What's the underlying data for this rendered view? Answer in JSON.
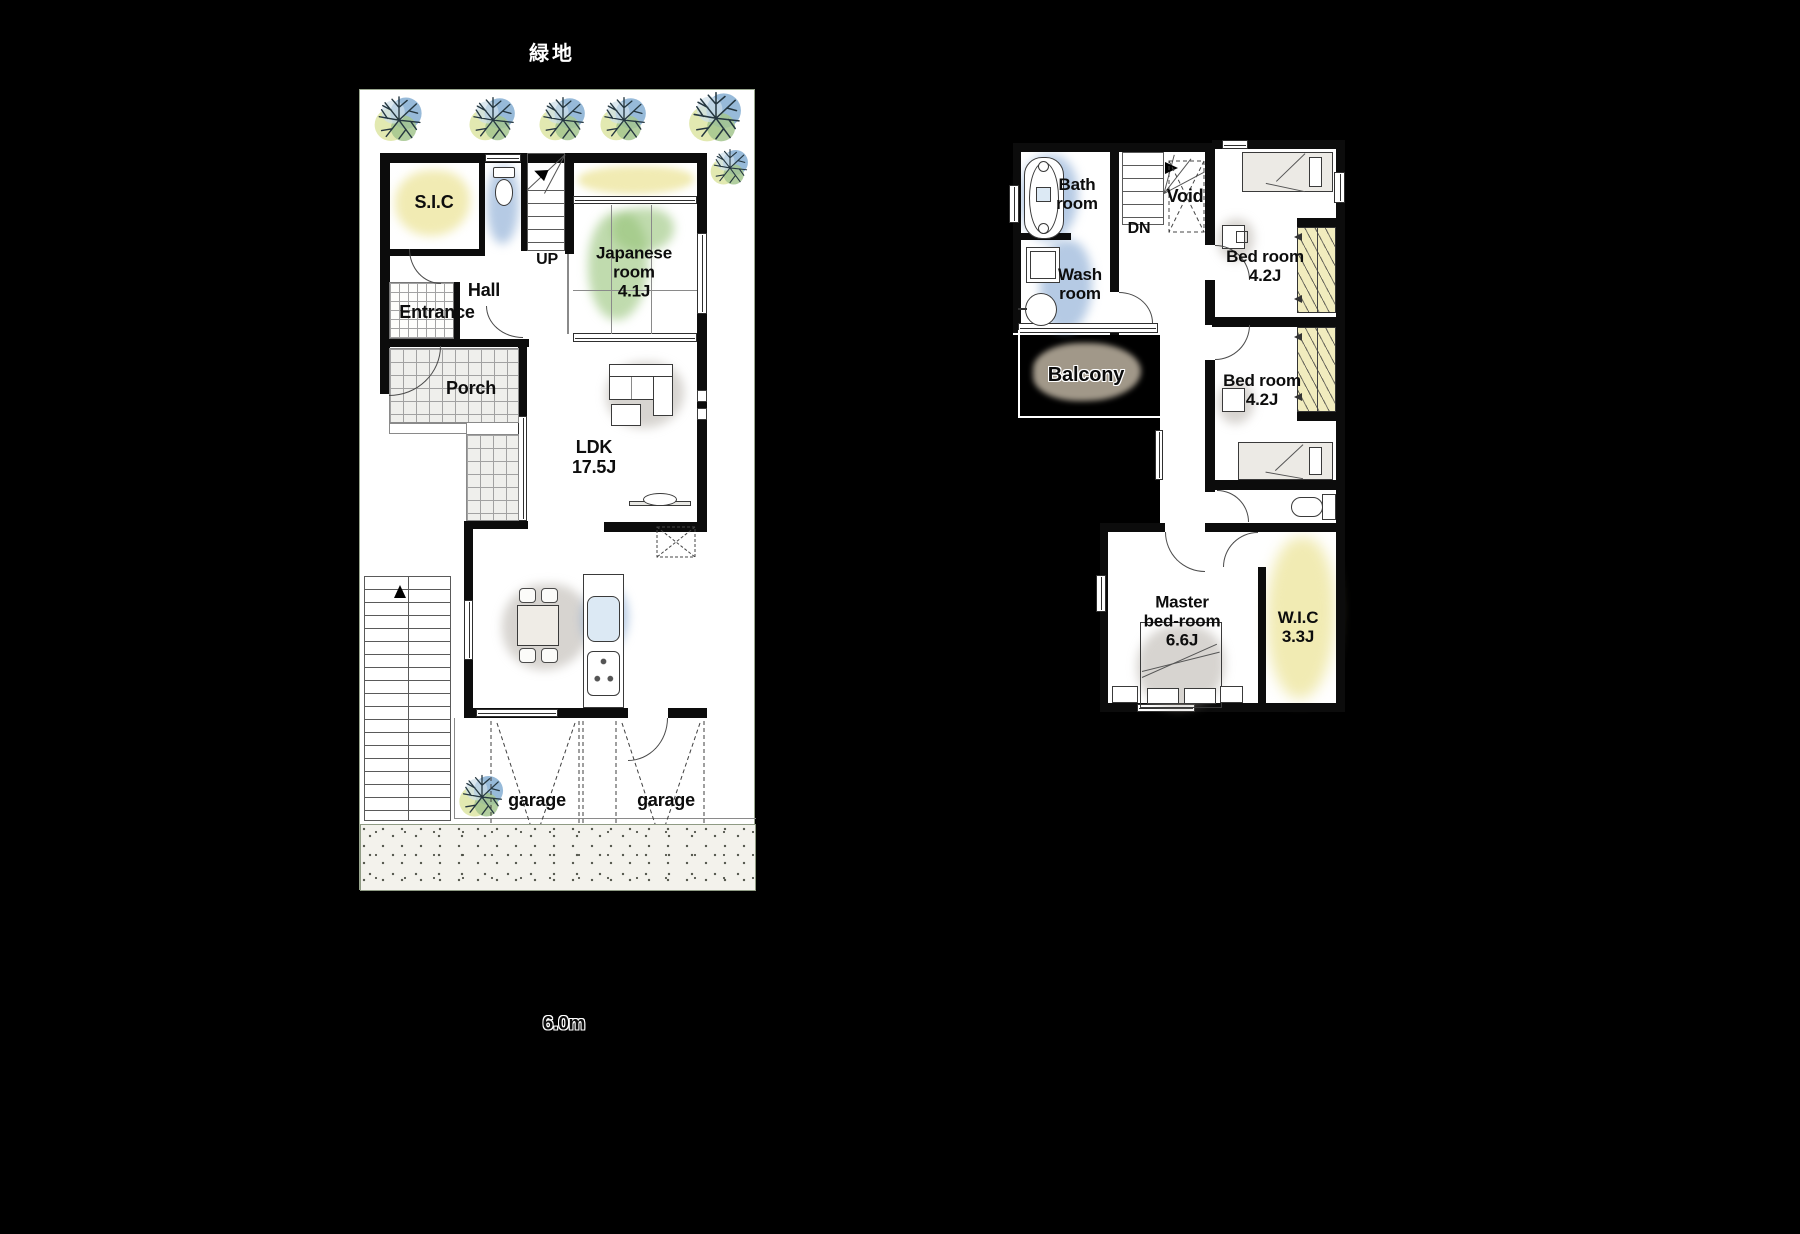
{
  "site": {
    "green_area_label": "緑地",
    "road_width_label": "6.0m"
  },
  "floor1": {
    "stair_label": "UP",
    "rooms": {
      "sic": {
        "name": "S.I.C"
      },
      "hall": {
        "name": "Hall"
      },
      "entrance": {
        "name": "Entrance"
      },
      "porch": {
        "name": "Porch"
      },
      "japanese_room": {
        "name": "Japanese room",
        "size": "4.1J"
      },
      "ldk": {
        "name": "LDK",
        "size": "17.5J"
      },
      "garage_left": {
        "name": "garage"
      },
      "garage_right": {
        "name": "garage"
      }
    }
  },
  "floor2": {
    "stair_label": "DN",
    "rooms": {
      "bath": {
        "name": "Bath room"
      },
      "wash": {
        "name": "Wash room"
      },
      "void": {
        "name": "Void"
      },
      "bedroom_upper": {
        "name": "Bed room",
        "size": "4.2J"
      },
      "bedroom_lower": {
        "name": "Bed room",
        "size": "4.2J"
      },
      "balcony": {
        "name": "Balcony"
      },
      "master_bedroom": {
        "name": "Master bed-room",
        "size": "6.6J"
      },
      "wic": {
        "name": "W.I.C",
        "size": "3.3J"
      }
    }
  },
  "colors": {
    "background": "#000000",
    "paper": "#ffffff",
    "wall": "#0c0c0c",
    "wash_yellow": "#eee6a0",
    "wash_green": "#96c378",
    "wash_blue": "#87aad4",
    "wash_gray": "#a0998e",
    "balcony_fill": "#a19889",
    "tile_line": "#a2a2a2"
  }
}
